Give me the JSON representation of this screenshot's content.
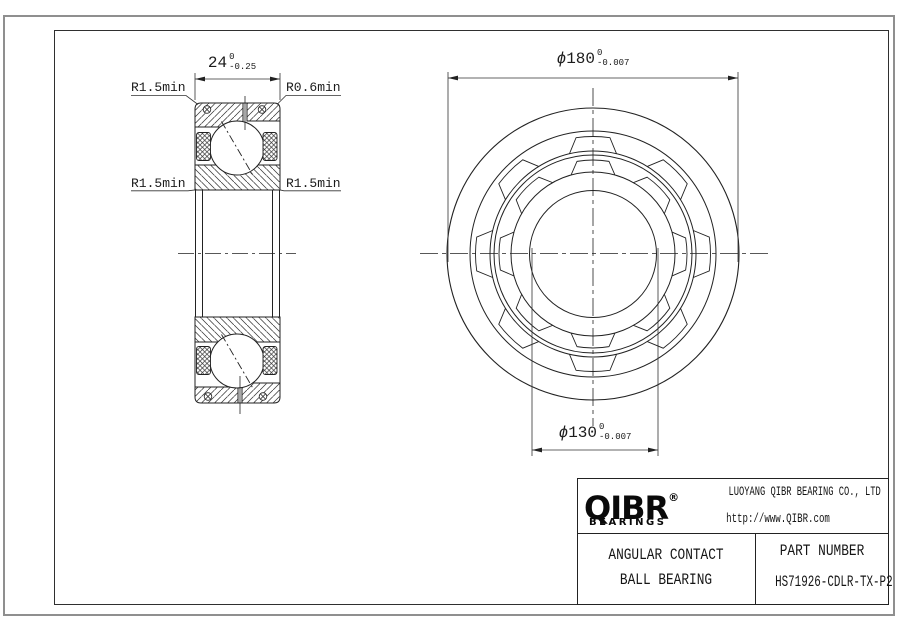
{
  "left_view": {
    "width_dim": {
      "value": "24",
      "tol_upper": "0",
      "tol_lower": "-0.25"
    },
    "radius_labels": {
      "top_left": "R1.5min",
      "top_right": "R0.6min",
      "mid_left": "R1.5min",
      "mid_right": "R1.5min"
    }
  },
  "front_view": {
    "outer_diameter_dim": {
      "symbol": "ϕ",
      "value": "180",
      "tol_upper": "0",
      "tol_lower": "-0.007"
    },
    "bore_diameter_dim": {
      "symbol": "ϕ",
      "value": "130",
      "tol_upper": "0",
      "tol_lower": "-0.007"
    }
  },
  "title_block": {
    "logo": {
      "brand": "QIBR",
      "registered_mark": "®",
      "tagline": "BEARINGS"
    },
    "company_name": "LUOYANG QIBR BEARING CO., LTD",
    "website": "http://www.QIBR.com",
    "product_type_line1": "ANGULAR CONTACT",
    "product_type_line2": "BALL BEARING",
    "part_number_label": "PART NUMBER",
    "part_number": "HS71926-CDLR-TX-P2"
  },
  "colors": {
    "line": "#222222",
    "thin_line": "#333333",
    "frame_outer": "#8f8f8f",
    "background": "#ffffff"
  }
}
